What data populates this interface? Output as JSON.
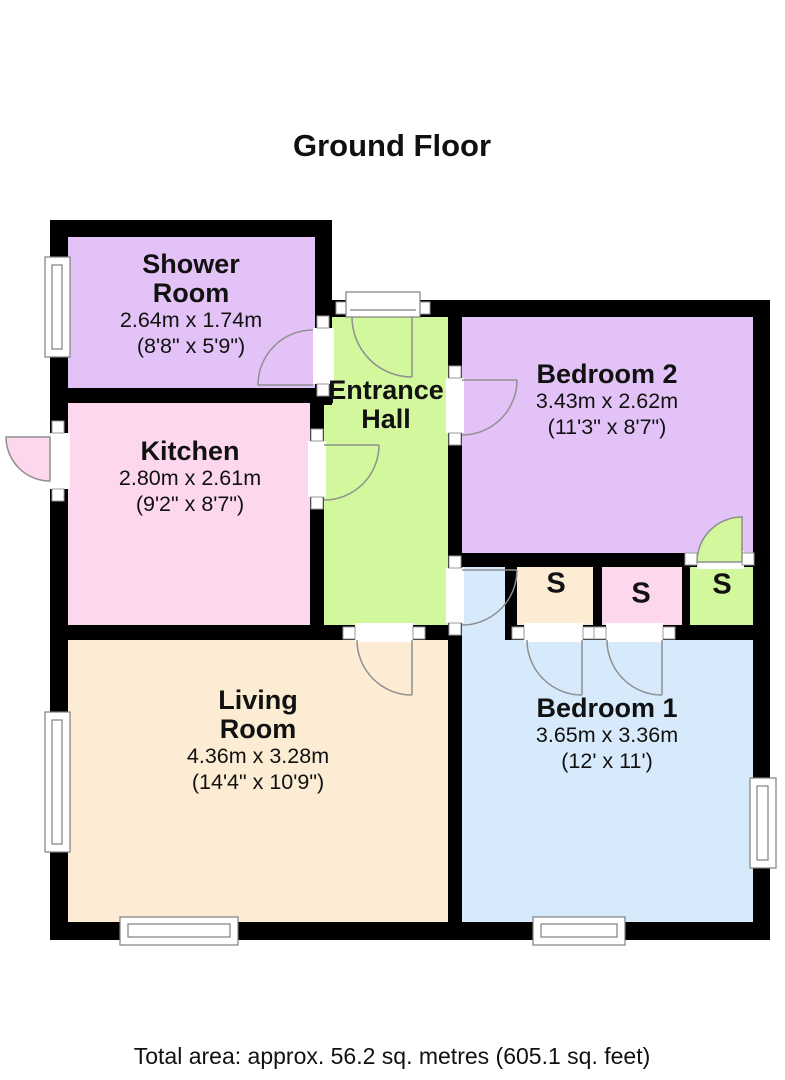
{
  "title": "Ground Floor",
  "footer": "Total area: approx. 56.2 sq. metres (605.1 sq. feet)",
  "wall_color": "#000000",
  "rooms": {
    "shower": {
      "name": "Shower Room",
      "dims_m": "2.64m x 1.74m",
      "dims_ft": "(8'8\" x 5'9\")",
      "color": "#e3c3f7"
    },
    "kitchen": {
      "name": "Kitchen",
      "dims_m": "2.80m x 2.61m",
      "dims_ft": "(9'2\" x 8'7\")",
      "color": "#fdd7ee"
    },
    "hall": {
      "name": "Entrance Hall",
      "color": "#d2f79c"
    },
    "bedroom2": {
      "name": "Bedroom 2",
      "dims_m": "3.43m x 2.62m",
      "dims_ft": "(11'3\" x 8'7\")",
      "color": "#e3c3f7"
    },
    "living": {
      "name": "Living Room",
      "dims_m": "4.36m x 3.28m",
      "dims_ft": "(14'4\" x 10'9\")",
      "color": "#fcecd4"
    },
    "bedroom1": {
      "name": "Bedroom 1",
      "dims_m": "3.65m x 3.36m",
      "dims_ft": "(12' x 11')",
      "color": "#d7eafb"
    }
  },
  "storage": {
    "label": "S",
    "units": [
      {
        "name": "storage-cream",
        "color": "#fcecd4"
      },
      {
        "name": "storage-pink",
        "color": "#fdd7ee"
      },
      {
        "name": "storage-green",
        "color": "#d2f79c"
      }
    ]
  }
}
